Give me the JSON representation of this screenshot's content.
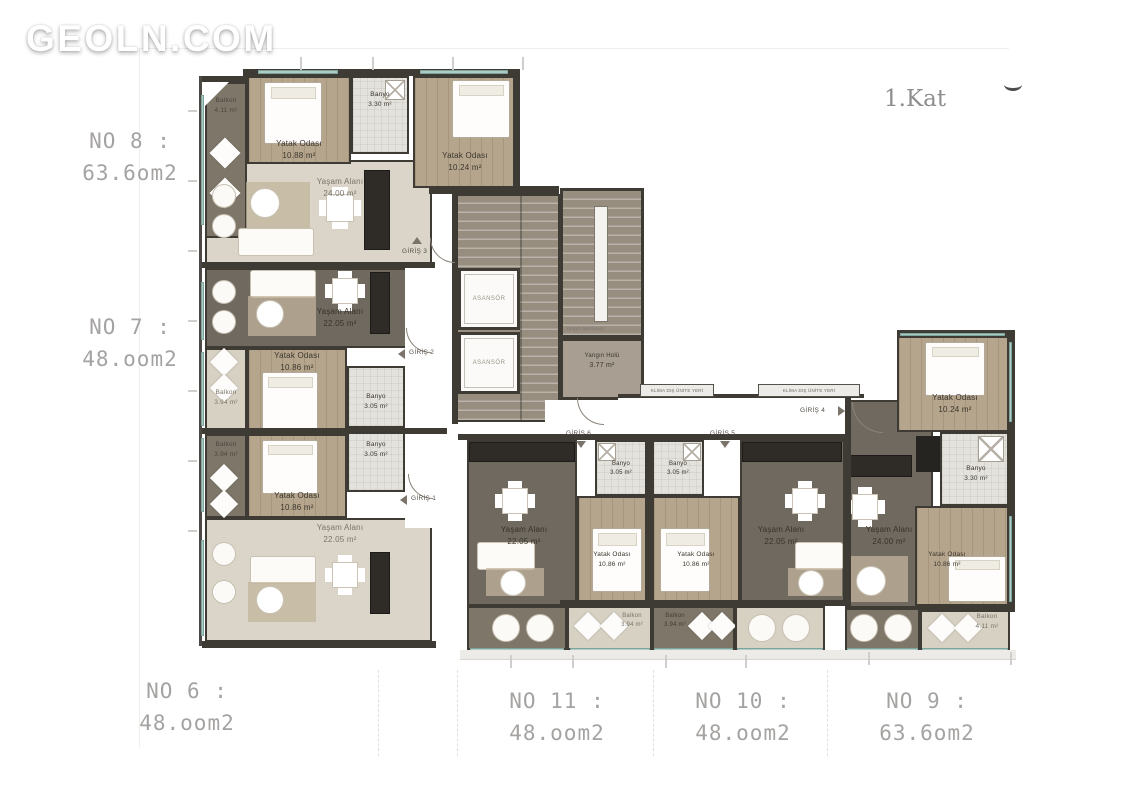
{
  "watermark": "GEOLN.COM",
  "floor_label": "1.Kat",
  "apartments": {
    "no8": {
      "no": "NO 8 :",
      "area": "63.6om2"
    },
    "no7": {
      "no": "NO 7 :",
      "area": "48.oom2"
    },
    "no6": {
      "no": "NO 6 :",
      "area": "48.oom2"
    },
    "no11": {
      "no": "NO 11 :",
      "area": "48.oom2"
    },
    "no10": {
      "no": "NO 10 :",
      "area": "48.oom2"
    },
    "no9": {
      "no": "NO 9 :",
      "area": "63.6om2"
    }
  },
  "rooms": {
    "no8_balkon": {
      "name": "Balkon",
      "area": "4.11 m²"
    },
    "no8_yatak1": {
      "name": "Yatak Odası",
      "area": "10.88 m²"
    },
    "no8_banyo": {
      "name": "Banyo",
      "area": "3.30 m²"
    },
    "no8_yatak2": {
      "name": "Yatak Odası",
      "area": "10.24 m²"
    },
    "no8_yasam": {
      "name": "Yaşam Alanı",
      "area": "24.00 m²"
    },
    "no7_yasam": {
      "name": "Yaşam Alanı",
      "area": "22.05 m²"
    },
    "no7_yatak": {
      "name": "Yatak Odası",
      "area": "10.86 m²"
    },
    "no7_balkon": {
      "name": "Balkon",
      "area": "3.94 m²"
    },
    "no7_banyo": {
      "name": "Banyo",
      "area": "3.05 m²"
    },
    "no6_banyo": {
      "name": "Banyo",
      "area": "3.05 m²"
    },
    "no6_yatak": {
      "name": "Yatak Odası",
      "area": "10.86 m²"
    },
    "no6_balkon": {
      "name": "Balkon",
      "area": "3.94 m²"
    },
    "no6_yasam": {
      "name": "Yaşam Alanı",
      "area": "22.05 m²"
    },
    "no11_yasam": {
      "name": "Yaşam Alanı",
      "area": "22.05 m²"
    },
    "no11_yatak": {
      "name": "Yatak Odası",
      "area": "10.86 m²"
    },
    "no11_banyo": {
      "name": "Banyo",
      "area": "3.05 m²"
    },
    "no11_balkon": {
      "name": "Balkon",
      "area": "3.94 m²"
    },
    "no10_yasam": {
      "name": "Yaşam Alanı",
      "area": "22.05 m²"
    },
    "no10_yatak": {
      "name": "Yatak Odası",
      "area": "10.86 m²"
    },
    "no10_banyo": {
      "name": "Banyo",
      "area": "3.05 m²"
    },
    "no10_balkon": {
      "name": "Balkon",
      "area": "3.94 m²"
    },
    "no9_yatak1": {
      "name": "Yatak Odası",
      "area": "10.24 m²"
    },
    "no9_banyo": {
      "name": "Banyo",
      "area": "3.30 m²"
    },
    "no9_yasam": {
      "name": "Yaşam Alanı",
      "area": "24.00 m²"
    },
    "no9_yatak2": {
      "name": "Yatak Odası",
      "area": "10.86 m²"
    },
    "no9_balkon": {
      "name": "Balkon",
      "area": "4.11 m²"
    }
  },
  "core": {
    "asansor": "ASANSÖR",
    "hol_name": "Yangın Holü",
    "hol_area": "3.77 m²",
    "merdiven": "Yangın Merdiveni"
  },
  "entrances": {
    "g1": "GİRİŞ 1",
    "g2": "GİRİŞ 2",
    "g3": "GİRİŞ 3",
    "g4": "GİRİŞ 4",
    "g5": "GİRİŞ 5",
    "g6": "GİRİŞ 6"
  },
  "klima_label": "KLİMA DIŞ ÜNİTE YERİ",
  "colors": {
    "wall": "#3e3a34",
    "floor_dark": "#6f695f",
    "floor_light": "#dad5c8",
    "wood": "#b5a58c",
    "window": "#aecbc4",
    "label_gray": "#a5a3a1"
  }
}
